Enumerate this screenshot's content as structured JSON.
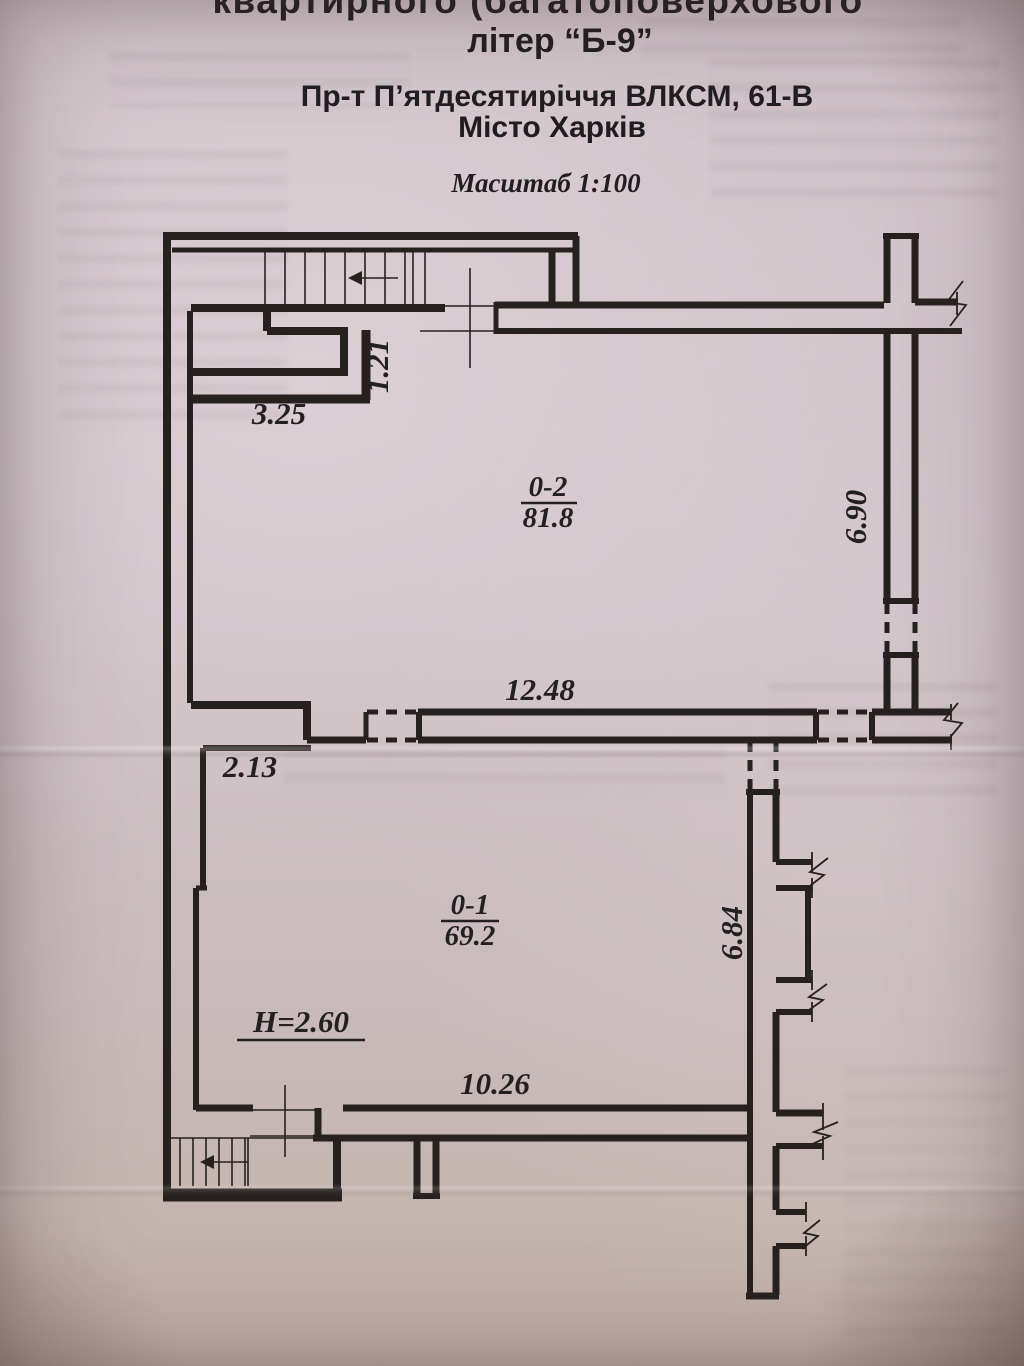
{
  "document": {
    "header": {
      "line1_clipped": "квартирного (багатоповерхового",
      "line2": "літер “Б-9”",
      "line3": "Пр-т П’ятдесятиріччя ВЛКСМ, 61-В",
      "line4": "Місто Харків",
      "scale_note": "Масштаб 1:100"
    },
    "plan": {
      "rooms": [
        {
          "id": "0-2",
          "area": "81.8"
        },
        {
          "id": "0-1",
          "area": "69.2"
        }
      ],
      "dimensions": {
        "stair_block_width": "3.25",
        "passage_width": "1.21",
        "hall_width": "12.48",
        "ledge_width": "2.13",
        "right_wall_upper": "6.90",
        "right_wall_lower": "6.84",
        "bottom_wall": "10.26",
        "ceiling_height": "H=2.60"
      }
    },
    "colors": {
      "paper": "#cec1c7",
      "ink": "#26211f"
    }
  }
}
